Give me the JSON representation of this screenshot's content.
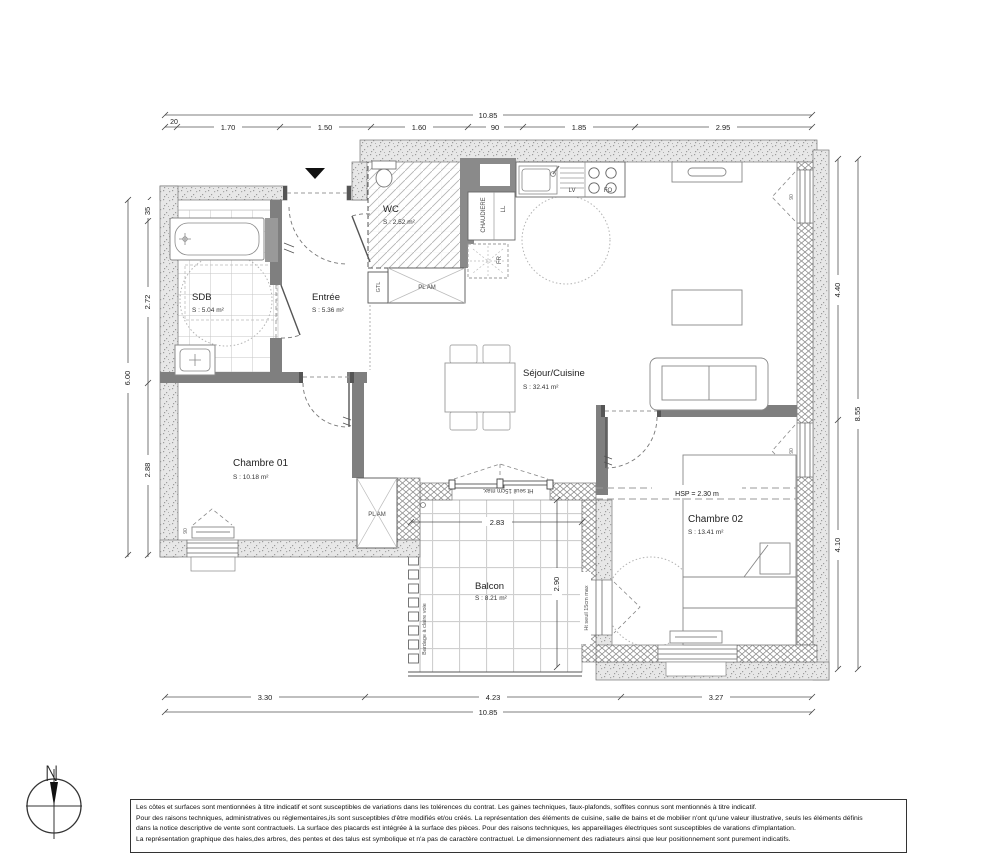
{
  "rooms": {
    "wc": {
      "name": "WC",
      "area": "S : 2.52 m²"
    },
    "sdb": {
      "name": "SDB",
      "area": "S : 5.04 m²"
    },
    "entree": {
      "name": "Entrée",
      "area": "S : 5.36 m²"
    },
    "sejour": {
      "name": "Séjour/Cuisine",
      "area": "S : 32.41 m²"
    },
    "chambre1": {
      "name": "Chambre 01",
      "area": "S : 10.18 m²"
    },
    "chambre2": {
      "name": "Chambre 02",
      "area": "S : 13.41 m²"
    },
    "balcon": {
      "name": "Balcon",
      "area": "S : 8.21 m²"
    }
  },
  "labels": {
    "chaudiere": "CHAUDIERE",
    "ll": "LL",
    "lv": "LV",
    "fo": "FO",
    "fr": "FR",
    "gtl": "GTL",
    "pl_am": "PL AM",
    "hsp": "HSP = 2.30 m",
    "ht_seuil_top": "Ht seuil 15cm max.",
    "ht_seuil_right": "Ht seuil 15cm max",
    "bardage": "Bardage à claire voie",
    "window_width": "90"
  },
  "dimensions": {
    "top": {
      "total": "10.85",
      "wall_offset": "20",
      "segments": [
        "1.70",
        "1.50",
        "1.60",
        "90",
        "1.85",
        "2.95"
      ]
    },
    "bottom": {
      "total": "10.85",
      "segments": [
        "3.30",
        "4.23",
        "3.27"
      ]
    },
    "left": {
      "total": "6.00",
      "segments": [
        "35",
        "2.72",
        "2.88"
      ]
    },
    "right": {
      "total": "8.55",
      "segments": [
        "4.40",
        "4.10"
      ]
    },
    "balcon": {
      "width": "2.83",
      "depth": "2.90"
    }
  },
  "compass": {
    "north_label": "N"
  },
  "title_block": {
    "lines": [
      "Les côtes et surfaces sont mentionnées à titre indicatif et sont susceptibles de variations dans les tolérences du contrat. Les gaines techniques, faux-plafonds, soffites connus sont mentionnés à titre indicatif.",
      "Pour des raisons techniques, administratives ou réglementaires,ils sont susceptibles d'être modifiés et/ou créés. La représentation des éléments de cuisine, salle de bains et de mobilier n'ont qu'une valeur illustrative, seuls les éléments définis",
      "dans la notice descriptive de vente sont contractuels. La surface des placards est intégrée à la surface des pièces. Pour des raisons techniques, les appareillages électriques sont susceptibles  de varations d'implantation.",
      "La représentation graphique  des haies,des arbres, des pentes et des talus est  symbolique et n'a pas de caractère contractuel. Le dimensionnement des radiateurs ainsi que leur positionnement sont purement indicatifs."
    ]
  },
  "colors": {
    "ink": "#333333",
    "interior_wall": "#7f7f7f",
    "exterior_wall_fill": "#e7e7e7",
    "north_needle": "#111111"
  }
}
